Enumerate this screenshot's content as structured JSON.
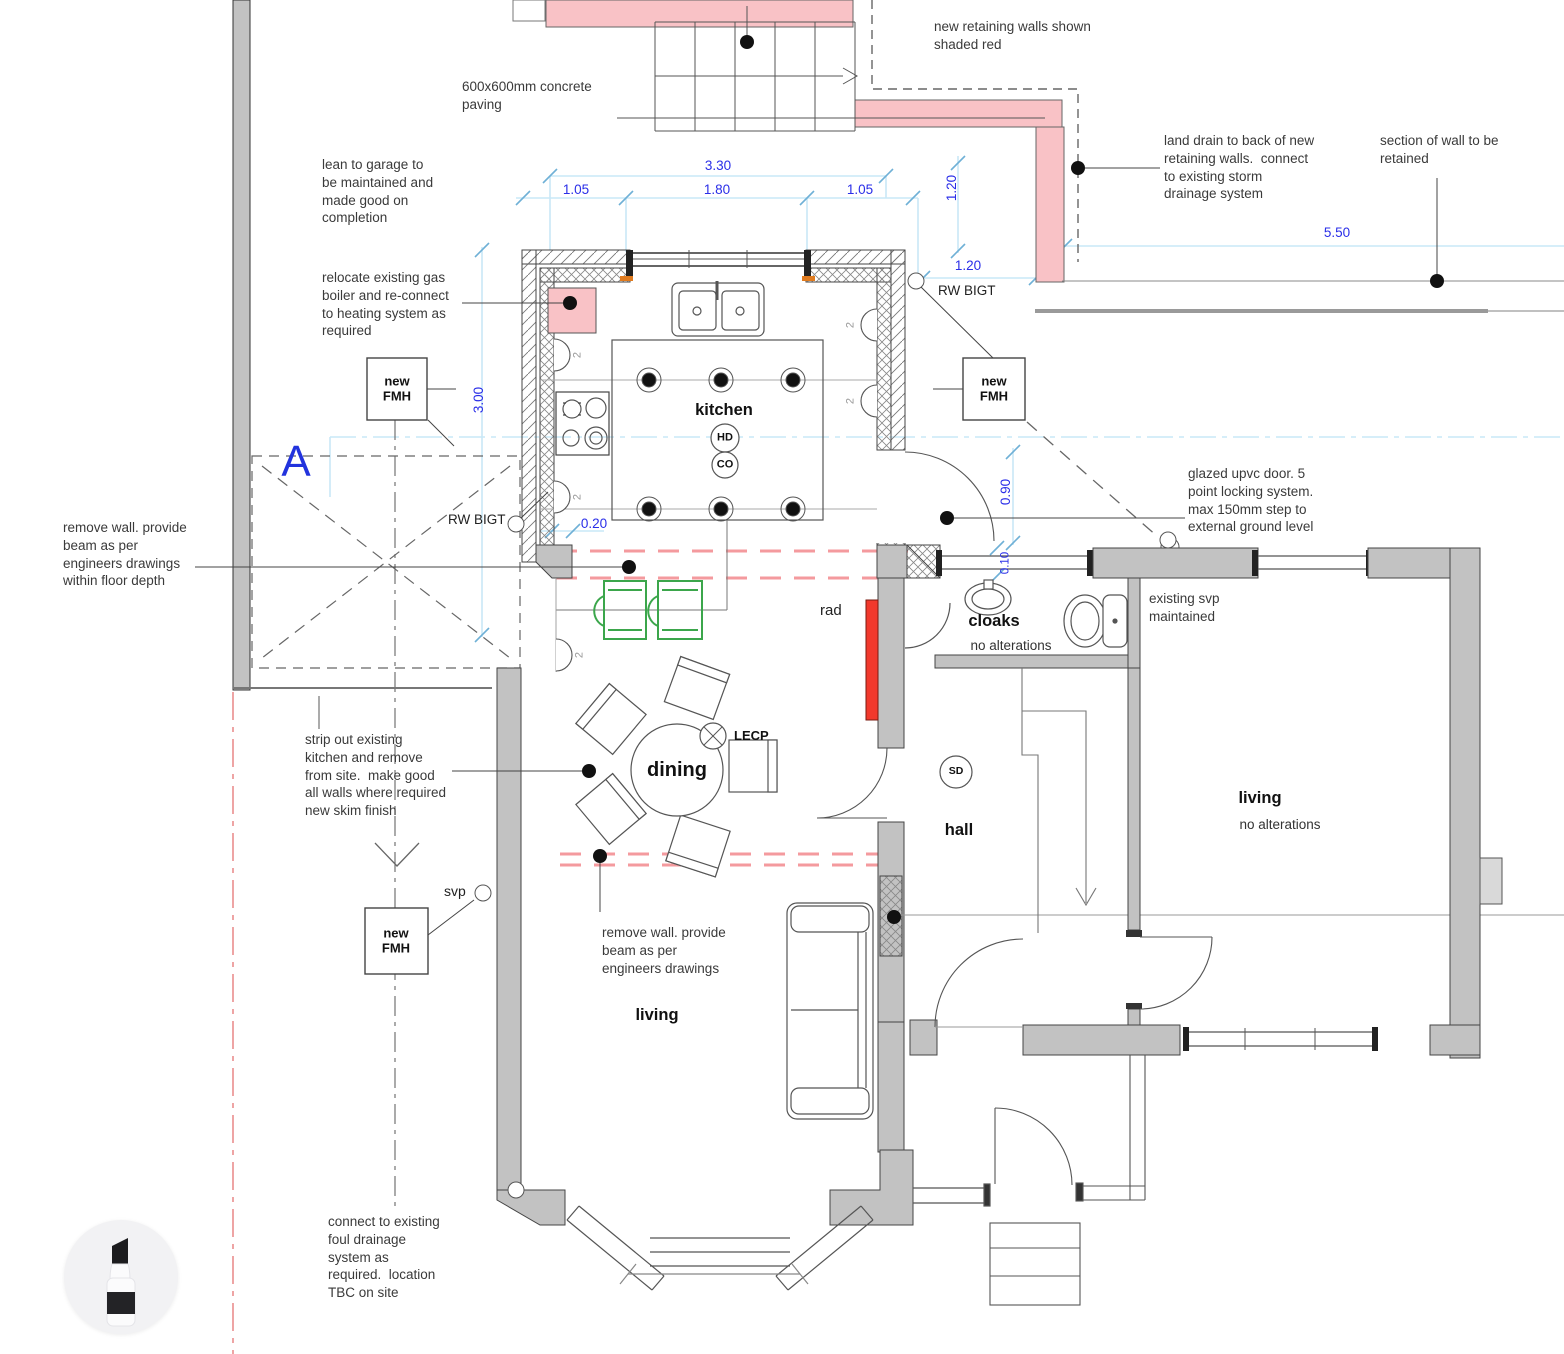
{
  "notes": {
    "paving": "600x600mm concrete\npaving",
    "retaining": "new retaining walls shown\nshaded red",
    "land_drain": "land drain to back of new\nretaining walls.  connect\nto existing storm\ndrainage system",
    "wall_retained": "section of wall to be\nretained",
    "lean_to": "lean to garage to\nbe maintained and\nmade good on\ncompletion",
    "boiler": "relocate existing gas\nboiler and re-connect\nto heating system as\nrequired",
    "remove_wall_floor": "remove wall. provide\nbeam as per\nengineers drawings\nwithin floor depth",
    "glazed_door": "glazed upvc door. 5\npoint locking system.\nmax 150mm step to\nexternal ground level",
    "strip_out": "strip out existing\nkitchen and remove\nfrom site.  make good\nall walls where required\nnew skim finish",
    "svp_maintained": "existing svp\nmaintained",
    "remove_wall_beam": "remove wall. provide\nbeam as per\nengineers drawings",
    "foul_drainage": "connect to existing\nfoul drainage\nsystem as\nrequired.  location\nTBC on site"
  },
  "rooms": {
    "kitchen": "kitchen",
    "dining": "dining",
    "hall": "hall",
    "cloaks": "cloaks",
    "living": "living",
    "no_alterations": "no alterations"
  },
  "markers": {
    "fmh": "new\nFMH",
    "rw_bigt": "RW BIGT",
    "svp": "svp",
    "rad": "rad",
    "lecp": "LECP",
    "hd": "HD",
    "co": "CO",
    "sd": "SD",
    "section_a": "A",
    "wall_light_count": "2"
  },
  "dims": {
    "d330": "3.30",
    "d105": "1.05",
    "d180": "1.80",
    "d120": "1.20",
    "d550": "5.50",
    "d300": "3.00",
    "d020": "0.20",
    "d090": "0.90",
    "d010": "0.10"
  },
  "colors": {
    "retaining_pink": "#f9c2c6",
    "removed_wall_red": "#f49a9e",
    "radiator_red": "#f2392c",
    "dimension_blue": "#2a2ee8",
    "construction_blue": "#c9e8f7",
    "wall_gray": "#c2c2c2",
    "chair_green": "#3ba64b"
  },
  "tools": {
    "marker": "marker-tool"
  }
}
